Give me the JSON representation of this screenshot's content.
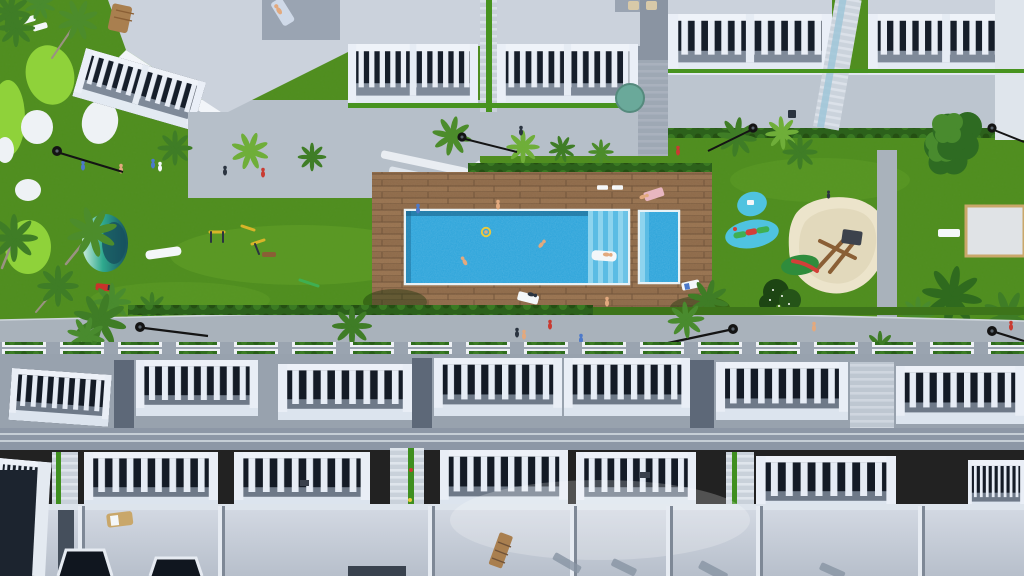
{
  "meta": {
    "title": "Aerial top-down 3D render of a residential complex with communal pool and gardens",
    "image_type": "architectural-render",
    "viewpoint": "top-down aerial"
  },
  "palette": {
    "lawn": "#4f8e1e",
    "lawn_light": "#65a42b",
    "lawn_dark": "#3d741a",
    "golf_light": "#8fd23a",
    "bunker_white": "#eef2f5",
    "pool_blue": "#2aa3da",
    "pool_shadow": "#14567c",
    "pool_step_light": "#8ed4ee",
    "pool_step_mid": "#5bbce4",
    "pool_rim": "#e8f2f6",
    "deck_wood": "#8e6a49",
    "deck_wood_dark": "#6f5238",
    "deck_wood_light": "#9b7755",
    "path_gray": "#a9b2bb",
    "plaza_gray": "#b6bfc9",
    "patio_gray": "#bcc5cf",
    "alley_gray": "#8a94a2",
    "building_white": "#eef2f8",
    "building_shade": "#dfe6ef",
    "roof_top": "#cbd2dc",
    "roof_terrace": "#9aa4b2",
    "roof_plane": "#c6cdd7",
    "roof_slope": "#8d97a6",
    "window_dark": "#161e2a",
    "glass_aqua": "#9fc6d8",
    "hedge_green": "#2c611b",
    "palm_green": "#3f7d26",
    "palm_light": "#6fae39",
    "tree_dark": "#24541a",
    "pond_light": "#cdeedd",
    "pond_mid": "#2fa98e",
    "pond_dark": "#17505e",
    "sand": "#ece4cb",
    "sand_shade": "#dcd2b2",
    "umbrella_teal": "#6aa99a",
    "wood_tan": "#a97f4f",
    "lamp_black": "#141414",
    "toy_red": "#d23f38",
    "toy_green": "#3faf52",
    "gym_yellow": "#d8b429",
    "skin": "#e2a97e",
    "shirt_blue": "#4d79c9",
    "shirt_red": "#c93b32",
    "shirt_dark": "#2b3440",
    "white": "#f4f7f9"
  },
  "scene": {
    "regions": [
      {
        "name": "top-building-row",
        "label": "Upper row of white apartment blocks with slatted roof-terrace balconies"
      },
      {
        "name": "golf-area",
        "label": "Mini-golf style green with light patches and white sand bunkers"
      },
      {
        "name": "central-lawn",
        "label": "Large communal lawn"
      },
      {
        "name": "pool-deck",
        "label": "Wooden deck with main swimming pool and children's pool"
      },
      {
        "name": "playground",
        "label": "Playground with splash ponds, sand pit and wooden climbing frame"
      },
      {
        "name": "pond",
        "label": "Teal ornamental pond"
      },
      {
        "name": "boules-court",
        "label": "Light paved court on right lawn"
      },
      {
        "name": "promenade",
        "label": "Grey pedestrian promenade with palms and street lamps"
      },
      {
        "name": "bottom-building-rows",
        "label": "Two staggered rows of white townhouses with balcony railings and grey roof decks"
      }
    ],
    "counts": {
      "swimming_pools": 2,
      "splash_ponds": 2,
      "street_lamps": 7,
      "sun_loungers": 9,
      "people_visible": 20,
      "palm_trees_approx": 18
    }
  }
}
